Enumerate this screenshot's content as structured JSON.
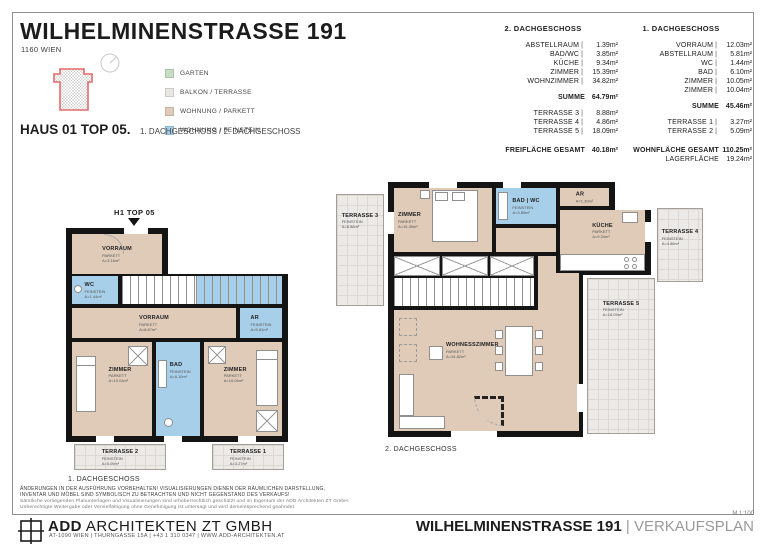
{
  "header": {
    "title": "WILHELMINENSTRASSE 191",
    "subtitle": "1160 WIEN",
    "haus_label": "HAUS 01 TOP 05.",
    "haus_floors": "1. DACHGESCHOSS / 2. DACHGESCHOSS"
  },
  "legend": {
    "items": [
      {
        "label": "GARTEN",
        "color": "#c9dcc4"
      },
      {
        "label": "BALKON / TERRASSE",
        "color": "#e9e7e3"
      },
      {
        "label": "WOHNUNG / PARKETT",
        "color": "#e0cbb9"
      },
      {
        "label": "WOHNUNG / FEINSTEIN",
        "color": "#a8cfe9"
      }
    ]
  },
  "summary": {
    "sep": "|",
    "dg2": {
      "title": "2. DACHGESCHOSS",
      "rows": [
        {
          "label": "ABSTELLRAUM",
          "value": "1.39m²"
        },
        {
          "label": "BAD/WC",
          "value": "3.85m²"
        },
        {
          "label": "KÜCHE",
          "value": "9.34m²"
        },
        {
          "label": "ZIMMER",
          "value": "15.39m²"
        },
        {
          "label": "WOHNZIMMER",
          "value": "34.82m²"
        }
      ],
      "summe": {
        "label": "SUMME",
        "value": "64.79m²"
      },
      "terraces": [
        {
          "label": "TERRASSE 3",
          "value": "8.88m²"
        },
        {
          "label": "TERRASSE 4",
          "value": "4.86m²"
        },
        {
          "label": "TERRASSE 5",
          "value": "18.09m²"
        }
      ],
      "total": {
        "label": "FREIFLÄCHE GESAMT",
        "value": "40.18m²"
      }
    },
    "dg1": {
      "title": "1. DACHGESCHOSS",
      "rows": [
        {
          "label": "VORRAUM",
          "value": "12.03m²"
        },
        {
          "label": "ABSTELLRAUM",
          "value": "5.81m²"
        },
        {
          "label": "WC",
          "value": "1.44m²"
        },
        {
          "label": "BAD",
          "value": "6.10m²"
        },
        {
          "label": "ZIMMER",
          "value": "10.05m²"
        },
        {
          "label": "ZIMMER",
          "value": "10.04m²"
        }
      ],
      "summe": {
        "label": "SUMME",
        "value": "45.46m²"
      },
      "terraces": [
        {
          "label": "TERRASSE 1",
          "value": "3.27m²"
        },
        {
          "label": "TERRASSE 2",
          "value": "5.09m²"
        }
      ],
      "total": {
        "label": "WOHNFLÄCHE GESAMT",
        "value": "110.25m²"
      },
      "extra": {
        "label": "LAGERFLÄCHE",
        "value": "19.24m²"
      }
    }
  },
  "plan1": {
    "marker": "H1 TOP 05",
    "caption": "1. DACHGESCHOSS",
    "rooms": {
      "vorraum_top": {
        "name": "VORRAUM",
        "finish": "PARKETT",
        "area": "A=3.16m²"
      },
      "wc": {
        "name": "WC",
        "finish": "FEINSTEIN",
        "area": "A=1.44m²"
      },
      "vorraum": {
        "name": "VORRAUM",
        "finish": "PARKETT",
        "area": "A=8.87m²"
      },
      "ar": {
        "name": "AR",
        "finish": "FEINSTEIN",
        "area": "A=5.81m²"
      },
      "zimmer_w": {
        "name": "ZIMMER",
        "finish": "PARKETT",
        "area": "A=10.04m²"
      },
      "bad": {
        "name": "BAD",
        "finish": "FEINSTEIN",
        "area": "A=6.10m²"
      },
      "zimmer_o": {
        "name": "ZIMMER",
        "finish": "PARKETT",
        "area": "A=10.05m²"
      },
      "terrasse2": {
        "name": "TERRASSE 2",
        "finish": "FEINSTEIN",
        "area": "A=5.09m²"
      },
      "terrasse1": {
        "name": "TERRASSE 1",
        "finish": "FEINSTEIN",
        "area": "A=3.27m²"
      }
    }
  },
  "plan2": {
    "caption": "2. DACHGESCHOSS",
    "rooms": {
      "terrasse3": {
        "name": "TERRASSE 3",
        "finish": "FEINSTEIN",
        "area": "A=8.88m²"
      },
      "zimmer": {
        "name": "ZIMMER",
        "finish": "PARKETT",
        "area": "A=15.39m²"
      },
      "badwc": {
        "name": "BAD | WC",
        "finish": "FEINSTEIN",
        "area": "A=3.85m²"
      },
      "ar": {
        "name": "AR",
        "finish": "PARKETT",
        "area": "A=1.39m²"
      },
      "kueche": {
        "name": "KÜCHE",
        "finish": "PARKETT",
        "area": "A=9.34m²"
      },
      "terrasse4": {
        "name": "TERRASSE 4",
        "finish": "FEINSTEIN",
        "area": "A=4.86m²"
      },
      "wohnesszimmer": {
        "name": "WOHNESSZIMMER",
        "finish": "PARKETT",
        "area": "A=34.82m²"
      },
      "terrasse5": {
        "name": "TERRASSE 5",
        "finish": "FEINSTEIN",
        "area": "A=18.09m²"
      }
    }
  },
  "footer": {
    "disclaimer": [
      "ÄNDERUNGEN IN DER AUSFÜHRUNG VORBEHALTEN! VISUALISIERUNGEN DIENEN DER RÄUMLICHEN DARSTELLUNG,",
      "INVENTAR UND MÖBEL SIND SYMBOLISCH ZU BETRACHTEN UND NICHT GEGENSTAND DES VERKAUFS!",
      "Sämtliche vorliegenden Planunterlagen und Visualisierungen sind urheberrechtlich geschützt und im Eigentum der ADD Architekten ZT GmbH.",
      "Unberechtigte Weitergabe oder Vervielfältigung ohne Genehmigung ist untersagt und wird dementsprechend geahndet."
    ],
    "firm_bold": "ADD",
    "firm_rest": " ARCHITEKTEN ZT GMBH",
    "contact": "AT-1090 WIEN | THURNGASSE 15A | +43 1 310 0347 | WWW.ADD-ARCHITEKTEN.AT",
    "scale": "M 1:100",
    "project": "WILHELMINENSTRASSE 191",
    "sep": "|",
    "doc_type": "VERKAUFSPLAN"
  },
  "colors": {
    "wall": "#141414",
    "garten": "#c9dcc4",
    "balkon_terrasse": "#e9e7e3",
    "wohnung_parkett": "#e0cbb9",
    "wohnung_feinstein": "#a8cfe9",
    "site_outline": "#e36a6a"
  }
}
